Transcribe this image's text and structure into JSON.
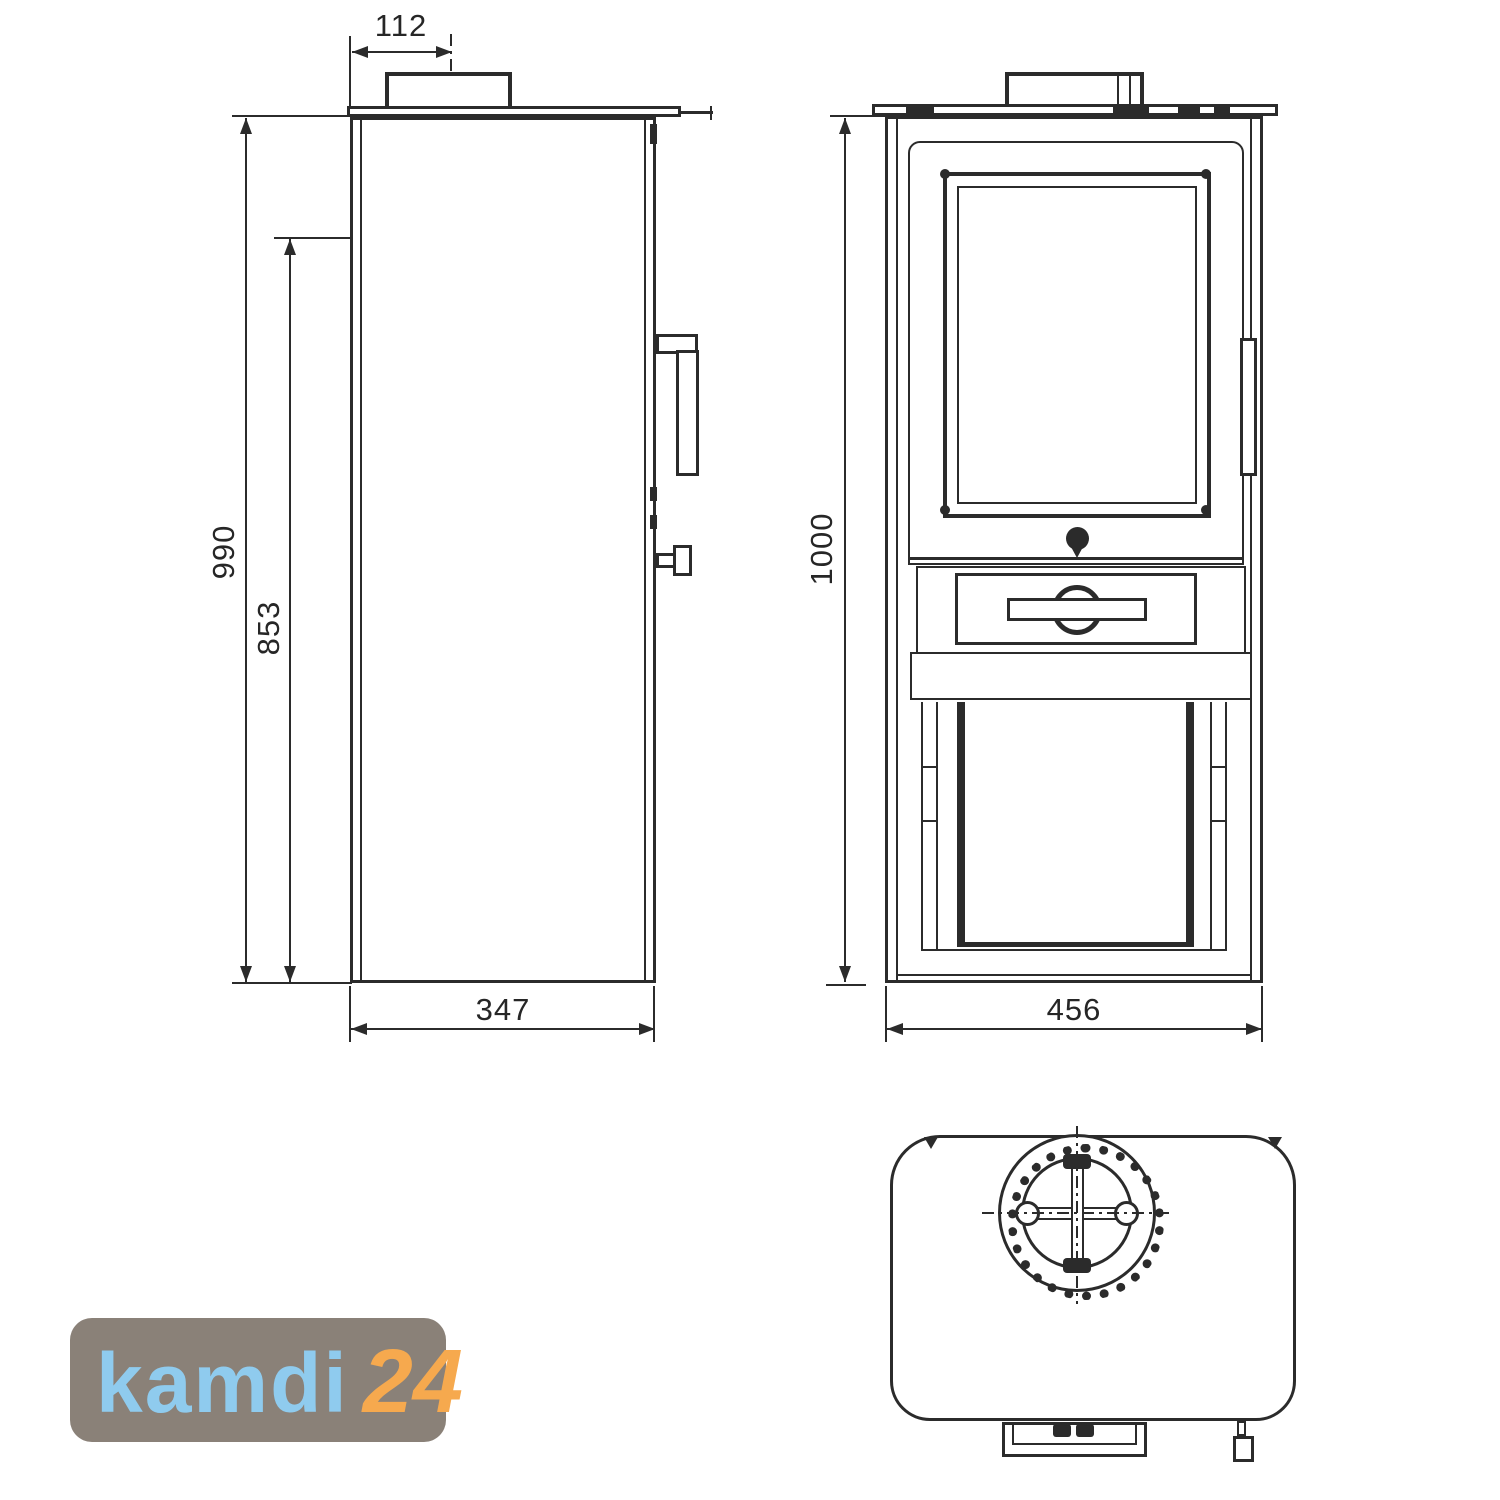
{
  "colors": {
    "line": "#2b2b2b",
    "logo_bg": "#8A8178",
    "logo_brand": "#8FCBEE",
    "logo_number": "#F6A94E"
  },
  "dimensions": {
    "flue_center_offset": "112",
    "total_height": "990",
    "inner_height": "853",
    "depth": "347",
    "front_height": "1000",
    "width": "456"
  },
  "logo": {
    "brand": "kamdi",
    "number": "24"
  }
}
